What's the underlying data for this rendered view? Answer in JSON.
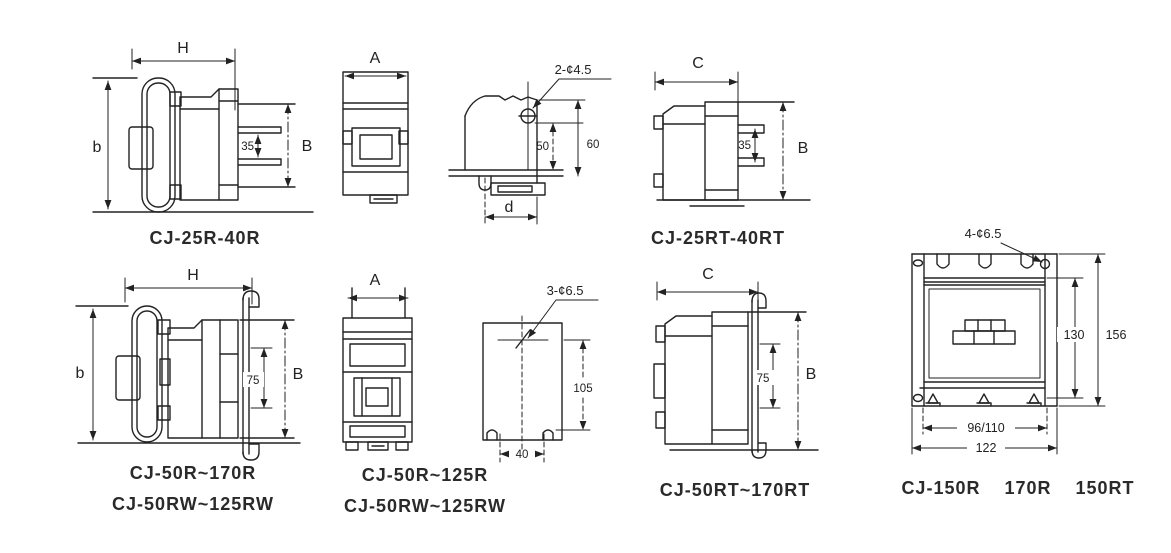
{
  "figure": {
    "bg": "#ffffff",
    "ink": "#222222"
  },
  "drawings": {
    "cj25r_side": {
      "caption": "CJ-25R-40R",
      "dim_width": "H",
      "dim_height_left": "b",
      "dim_height_right": "B",
      "dim_terminal_span": "35"
    },
    "front_view_small": {
      "dim_width": "A"
    },
    "mount_view_small": {
      "hole_callout": "2-¢4.5",
      "dim_hole_to_base": "50",
      "dim_top_to_base": "60",
      "dim_foot_width": "d"
    },
    "cj25rt_side": {
      "caption": "CJ-25RT-40RT",
      "dim_width": "C",
      "dim_height_right": "B",
      "dim_terminal_span": "35"
    },
    "cj50r_side": {
      "caption_line1": "CJ-50R~170R",
      "caption_line2": "CJ-50RW~125RW",
      "dim_width": "H",
      "dim_height_left": "b",
      "dim_height_right": "B",
      "dim_terminal_span": "75"
    },
    "front_view_large": {
      "caption_line1": "CJ-50R~125R",
      "caption_line2": "CJ-50RW~125RW",
      "dim_width": "A"
    },
    "mount_plate": {
      "hole_callout": "3-¢6.5",
      "dim_height": "105",
      "dim_hole_spacing": "40"
    },
    "cj50rt_side": {
      "caption": "CJ-50RT~170RT",
      "dim_width": "C",
      "dim_height_right": "B",
      "dim_terminal_span": "75"
    },
    "cj150r_front": {
      "caption": "CJ-150R    170R    150RT",
      "hole_callout": "4-¢6.5",
      "dim_inner_height": "130",
      "dim_outer_height": "156",
      "dim_inner_width": "96/110",
      "dim_outer_width": "122"
    }
  }
}
